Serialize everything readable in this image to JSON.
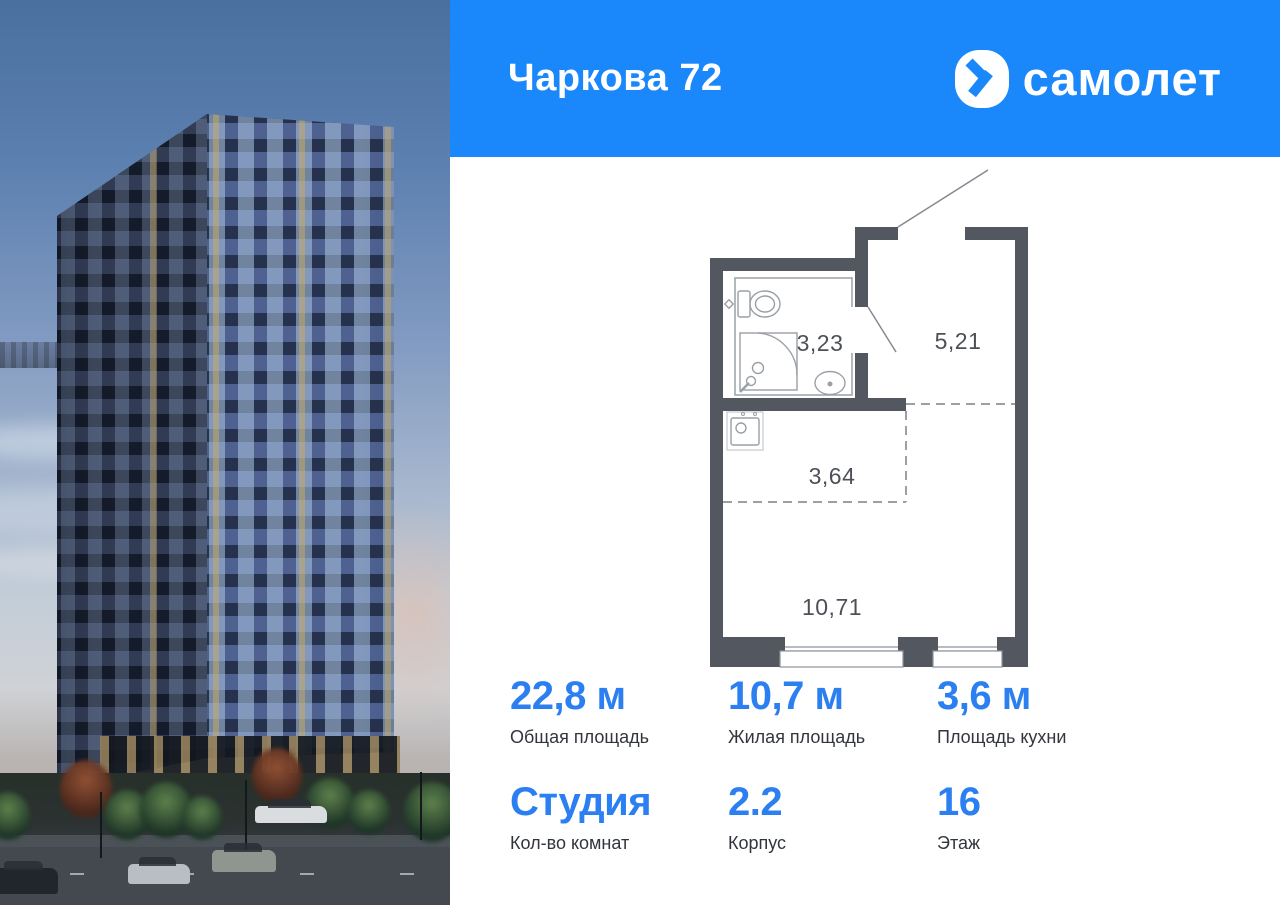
{
  "header": {
    "title": "Чаркова 72",
    "brand_wordmark": "самолет"
  },
  "floorplan": {
    "bathroom_area": "3,23",
    "hallway_area": "5,21",
    "kitchen_zone_area": "3,64",
    "living_area": "10,71"
  },
  "stats": [
    {
      "value": "22,8 м",
      "label": "Общая площадь"
    },
    {
      "value": "10,7 м",
      "label": "Жилая площадь"
    },
    {
      "value": "3,6 м",
      "label": "Площадь кухни"
    },
    {
      "value": "Студия",
      "label": "Кол-во комнат"
    },
    {
      "value": "2.2",
      "label": "Корпус"
    },
    {
      "value": "16",
      "label": "Этаж"
    }
  ],
  "colors": {
    "header_blue": "#1a87fa",
    "accent_blue": "#2b7ff0",
    "wall_gray": "#53575f"
  }
}
